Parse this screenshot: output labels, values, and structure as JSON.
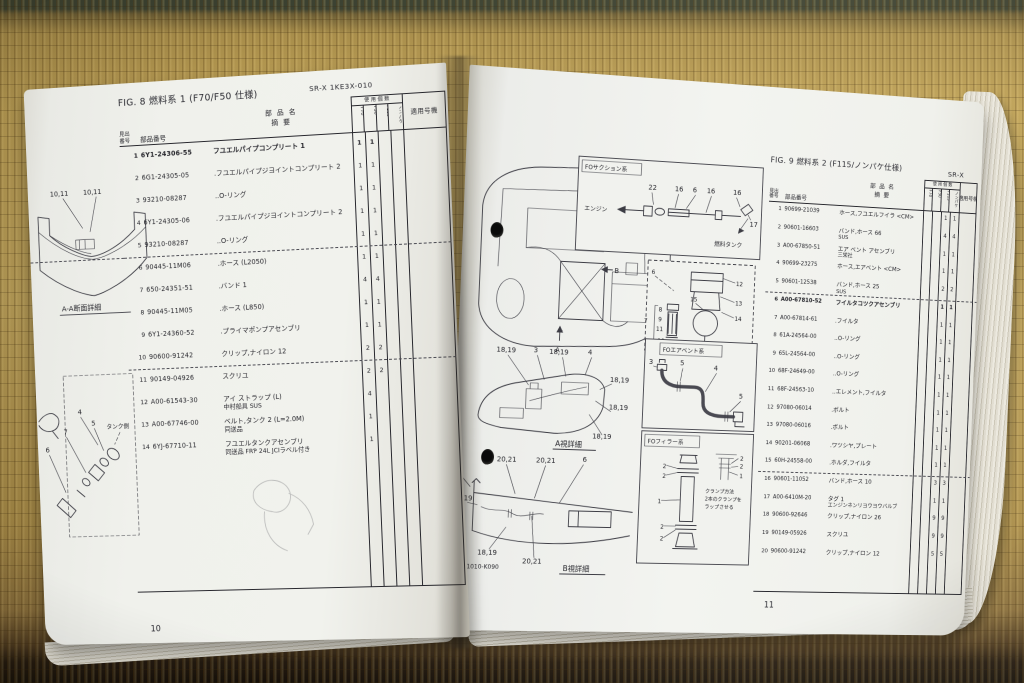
{
  "scene": {
    "left_page_number": "10",
    "right_page_number": "11"
  },
  "left_page": {
    "fig_title": "FIG. 8 燃料系 1 (F70/F50 仕様)",
    "doc_code": "SR-X 1KE3X-010",
    "table": {
      "item_label_1": "見出",
      "item_label_2": "番号",
      "part_label": "部品番号",
      "name_label_1": "部 品 名",
      "name_label_2": "摘  要",
      "qty_label": "使 用 個 数",
      "qty_cols": [
        "F70",
        "F50",
        "F115",
        "ノンパケ"
      ],
      "serial_label": "適用号機",
      "rows": [
        {
          "no": "1",
          "part": "6Y1-24306-55",
          "name": "フユエルパイプコンプリート 1",
          "q": [
            "1",
            "1",
            "",
            ""
          ],
          "bold": true
        },
        {
          "no": "2",
          "part": "6G1-24305-05",
          "name": ".フユエルパイプジヨイントコンプリート 2",
          "q": [
            "1",
            "1",
            "",
            ""
          ]
        },
        {
          "no": "3",
          "part": "93210-08287",
          "name": "..O-リング",
          "q": [
            "1",
            "1",
            "",
            ""
          ]
        },
        {
          "no": "4",
          "part": "6Y1-24305-06",
          "name": ".フユエルパイプジヨイントコンプリート 2",
          "q": [
            "1",
            "1",
            "",
            ""
          ]
        },
        {
          "no": "5",
          "part": "93210-08287",
          "name": "..O-リング",
          "q": [
            "1",
            "1",
            "",
            ""
          ],
          "dash": true
        },
        {
          "no": "6",
          "part": "90445-11M06",
          "name": ".ホース (L2050)",
          "q": [
            "1",
            "1",
            "",
            ""
          ]
        },
        {
          "no": "7",
          "part": "650-24351-51",
          "name": ".バンド 1",
          "q": [
            "4",
            "4",
            "",
            ""
          ]
        },
        {
          "no": "8",
          "part": "90445-11M05",
          "name": ".ホース (L850)",
          "q": [
            "1",
            "1",
            "",
            ""
          ]
        },
        {
          "no": "9",
          "part": "6Y1-24360-52",
          "name": ".プライマポンプアセンブリ",
          "q": [
            "1",
            "1",
            "",
            ""
          ]
        },
        {
          "no": "10",
          "part": "90600-91242",
          "name": "クリップ,ナイロン 12",
          "q": [
            "2",
            "2",
            "",
            ""
          ],
          "dash": true
        },
        {
          "no": "11",
          "part": "90149-04926",
          "name": "スクリユ",
          "q": [
            "2",
            "2",
            "",
            ""
          ]
        },
        {
          "no": "12",
          "part": "A00-61543-30",
          "name": "アイ ストラップ (L)",
          "name2": "中村船具 SUS",
          "q": [
            "4",
            "",
            "",
            ""
          ]
        },
        {
          "no": "13",
          "part": "A00-67746-00",
          "name": "ベルト,タンク 2 (L=2.0M)",
          "name2": "同送品",
          "q": [
            "1",
            "",
            "",
            ""
          ]
        },
        {
          "no": "14",
          "part": "6YJ-67710-11",
          "name": "フユエルタンクアセンブリ",
          "name2": "同送品 FRP 24L JCIラベル付き",
          "q": [
            "1",
            "",
            "",
            ""
          ]
        }
      ]
    },
    "diagrams": {
      "section": {
        "callout_a": "10,11",
        "callout_b": "10,11",
        "caption": "A-A断面詳細"
      },
      "tank": {
        "label": "タンク側",
        "c4": "4",
        "c5": "5",
        "c7": "7",
        "c6": "6"
      }
    }
  },
  "right_page": {
    "fig_title": "FIG. 9 燃料系 2 (F115/ノンパケ仕様)",
    "doc_code": "SR-X",
    "table": {
      "item_label_1": "見出",
      "item_label_2": "番号",
      "part_label": "部品番号",
      "name_label_1": "部 品 名",
      "name_label_2": "摘  要",
      "qty_label": "使 用 個 数",
      "qty_cols": [
        "F70",
        "F50",
        "F115",
        "ノンパケ"
      ],
      "serial_label": "適用号機",
      "rows": [
        {
          "no": "1",
          "part": "90699-21039",
          "name": "ホース,フユエルフイラ <CM>",
          "q": [
            "",
            "",
            "1",
            "1"
          ]
        },
        {
          "no": "2",
          "part": "90601-16603",
          "name": "バンド,ホース 66",
          "name2": "SUS",
          "q": [
            "",
            "",
            "4",
            "4"
          ]
        },
        {
          "no": "3",
          "part": "A00-67850-51",
          "name": "エア ベント アセンブリ",
          "name2": "三栄社",
          "q": [
            "",
            "",
            "1",
            "1"
          ]
        },
        {
          "no": "4",
          "part": "90699-23275",
          "name": "ホース,エアベント <CM>",
          "q": [
            "",
            "",
            "1",
            "1"
          ]
        },
        {
          "no": "5",
          "part": "90601-12538",
          "name": "バンド,ホース 25",
          "name2": "SUS",
          "q": [
            "",
            "",
            "2",
            "2"
          ],
          "dash": true
        },
        {
          "no": "6",
          "part": "A00-67810-52",
          "name": "フイルタコツクアセンブリ",
          "q": [
            "",
            "",
            "1",
            "1"
          ],
          "bold": true
        },
        {
          "no": "7",
          "part": "A00-67814-61",
          "name": ".フイルタ",
          "q": [
            "",
            "",
            "1",
            "1"
          ]
        },
        {
          "no": "8",
          "part": "61A-24564-00",
          "name": "..O-リング",
          "q": [
            "",
            "",
            "1",
            "1"
          ]
        },
        {
          "no": "9",
          "part": "65L-24564-00",
          "name": "..O-リング",
          "q": [
            "",
            "",
            "1",
            "1"
          ]
        },
        {
          "no": "10",
          "part": "68F-24649-00",
          "name": "..O-リング",
          "q": [
            "",
            "",
            "1",
            "1"
          ]
        },
        {
          "no": "11",
          "part": "68F-24563-10",
          "name": "..エレメント,フイルタ",
          "q": [
            "",
            "",
            "1",
            "1"
          ]
        },
        {
          "no": "12",
          "part": "97080-06014",
          "name": ".ボルト",
          "q": [
            "",
            "",
            "1",
            "1"
          ]
        },
        {
          "no": "13",
          "part": "97080-06016",
          "name": ".ボルト",
          "q": [
            "",
            "",
            "1",
            "1"
          ]
        },
        {
          "no": "14",
          "part": "90201-06068",
          "name": ".ワツシヤ,プレート",
          "q": [
            "",
            "",
            "1",
            "1"
          ]
        },
        {
          "no": "15",
          "part": "60H-24558-00",
          "name": ".ホルダ,フイルタ",
          "q": [
            "",
            "",
            "1",
            "1"
          ],
          "dash": true
        },
        {
          "no": "16",
          "part": "90601-11052",
          "name": "バンド,ホース 10",
          "q": [
            "",
            "",
            "3",
            "3"
          ]
        },
        {
          "no": "17",
          "part": "A00-6410M-20",
          "name": "タグ 1",
          "name2": "エンジンネンリヨウヨウバルブ",
          "q": [
            "",
            "",
            "1",
            "1"
          ]
        },
        {
          "no": "18",
          "part": "90600-92646",
          "name": "クリップ,ナイロン 26",
          "q": [
            "",
            "",
            "9",
            "9"
          ]
        },
        {
          "no": "19",
          "part": "90149-05926",
          "name": "スクリユ",
          "q": [
            "",
            "",
            "9",
            "9"
          ]
        },
        {
          "no": "20",
          "part": "90600-91242",
          "name": "クリップ,ナイロン 12",
          "q": [
            "",
            "",
            "5",
            "5"
          ]
        }
      ]
    },
    "diagrams": {
      "main": {
        "a_label": "A",
        "b_label": "B"
      },
      "suction": {
        "title": "FOサクション系",
        "engine": "エンジン",
        "tank": "燃料タンク",
        "c": [
          "22",
          "16",
          "6",
          "16",
          "16",
          "17"
        ]
      },
      "fdetail": {
        "c": [
          "6",
          "12",
          "13",
          "15",
          "14",
          "7",
          "8",
          "9",
          "11",
          "10"
        ]
      },
      "airvent": {
        "title": "FOエアベント系",
        "c": [
          "3",
          "5",
          "4",
          "5"
        ]
      },
      "filler": {
        "title": "FOフィラー系",
        "c": [
          "2",
          "2",
          "1",
          "2",
          "2"
        ],
        "inset": [
          "2",
          "2",
          "1"
        ],
        "note1": "クランプ方法",
        "note2": "2本のクランプを",
        "note3": "ラップさせる"
      },
      "view_a": {
        "caption": "A視詳細",
        "c": [
          "18,19",
          "3",
          "18,19",
          "4",
          "18,19",
          "18,19",
          "18,19"
        ]
      },
      "view_b": {
        "caption": "B視詳細",
        "code": "E3X1010-K090",
        "c": [
          "20,21",
          "20,21",
          "6",
          "3",
          "18,19",
          "18,19",
          "20,21"
        ]
      }
    }
  }
}
